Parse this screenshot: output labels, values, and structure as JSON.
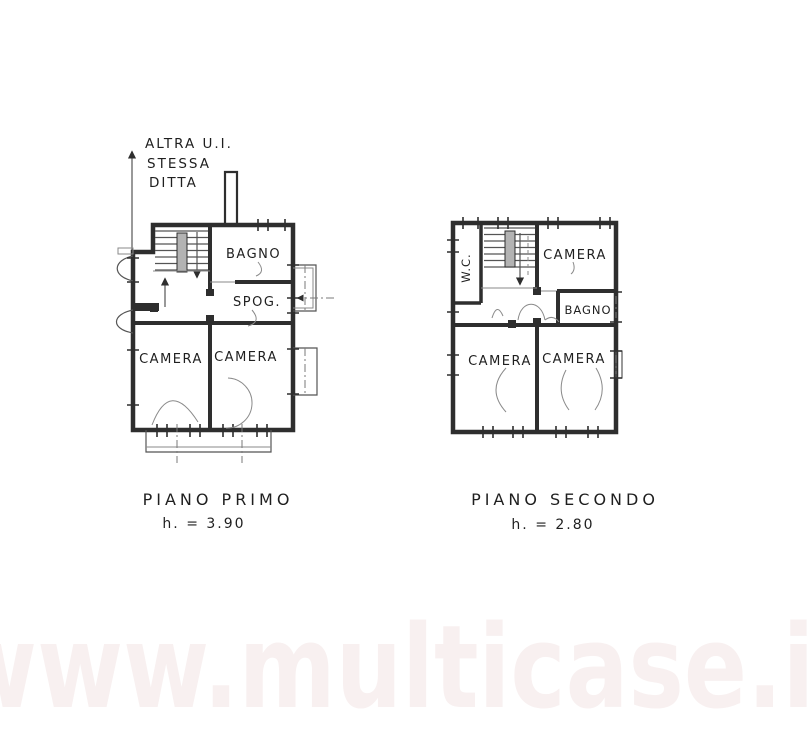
{
  "annotation": {
    "line1": "ALTRA U.I.",
    "line2": "STESSA",
    "line3": "DITTA"
  },
  "first_floor": {
    "caption": "PIANO PRIMO",
    "height_label": "h. = 3.90",
    "rooms": {
      "bagno": "BAGNO",
      "spogliatoio": "SPOG.",
      "camera_left": "CAMERA",
      "camera_right": "CAMERA"
    }
  },
  "second_floor": {
    "caption": "PIANO SECONDO",
    "height_label": "h. = 2.80",
    "rooms": {
      "wc": "W.C.",
      "camera_top": "CAMERA",
      "bagno": "BAGNO",
      "camera_left": "CAMERA",
      "camera_right": "CAMERA"
    }
  },
  "watermark": {
    "text": "www.multicase.it",
    "color": "#f8f0f0"
  },
  "colors": {
    "ink": "#2e2e2e",
    "paper": "#ffffff",
    "wall_fill": "#b3b3b3"
  }
}
